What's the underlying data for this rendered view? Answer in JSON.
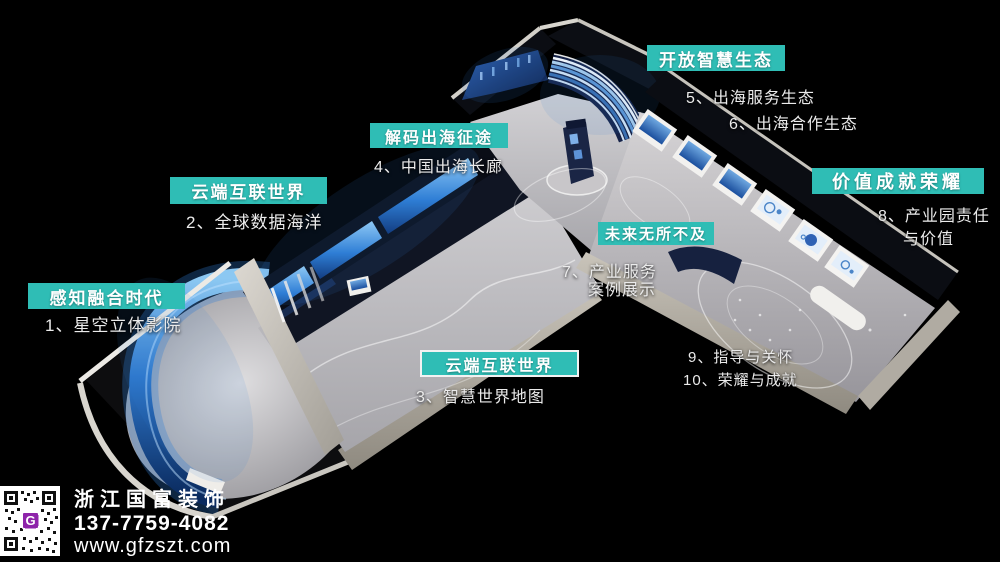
{
  "colors": {
    "background": "#000000",
    "label_bg": "#2fbdb5",
    "label_text": "#ffffff",
    "annotation_text": "#ebebeb"
  },
  "zones": [
    {
      "title": "感知融合时代",
      "item": "1、星空立体影院"
    },
    {
      "title": "云端互联世界",
      "item": "2、全球数据海洋"
    },
    {
      "title": "解码出海征途",
      "item": "4、中国出海长廊"
    },
    {
      "title": "开放智慧生态",
      "item1": "5、出海服务生态",
      "item2": "6、出海合作生态"
    },
    {
      "title": "价值成就荣耀",
      "item1": "8、产业园责任",
      "item2": "与价值"
    },
    {
      "title": "未来无所不及",
      "item1": "7、产业服务",
      "item2": "案例展示"
    },
    {
      "title": "云端互联世界",
      "item": "3、智慧世界地图"
    },
    {
      "item1": "9、指导与关怀",
      "item2": "10、荣耀与成就"
    }
  ],
  "branding": {
    "company": "浙江国富装饰",
    "phone": "137-7759-4082",
    "website": "www.gfzszt.com",
    "qr_letter": "G"
  }
}
